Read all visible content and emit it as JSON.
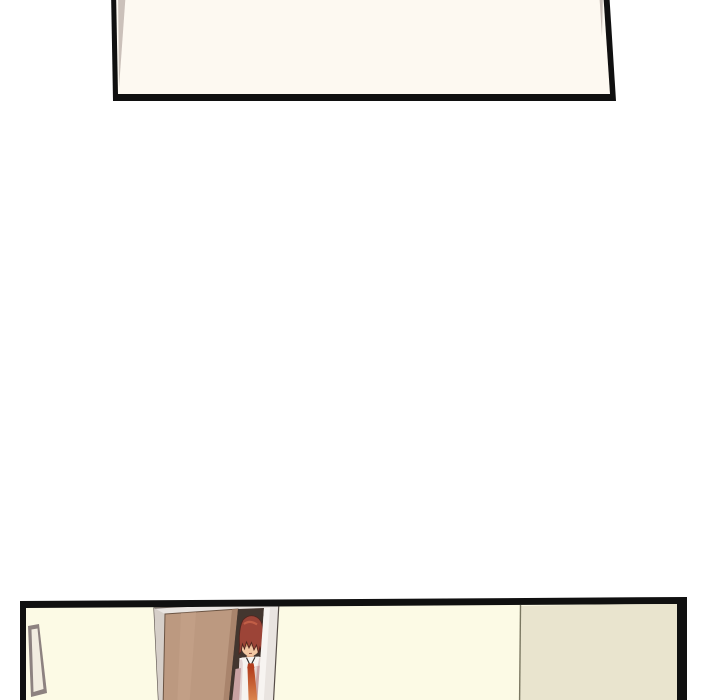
{
  "page": {
    "background_color": "#ffffff"
  },
  "panel_border_color": "#101010",
  "top_panel": {
    "wall_color": "#fdf9f1",
    "corner_shade_color": "#cbc1ba"
  },
  "bottom_panel": {
    "wall_color": "#fcfae5",
    "side_wall_color": "#e9e4ce",
    "wall_seam_color": "#6e6a55",
    "doorway_shadow_color": "#43362f",
    "door": {
      "fill": "#bc9980",
      "edge_shade": "#a9846c",
      "highlight": "#c9a78f",
      "outline": "#6b5443"
    },
    "door_frame": {
      "fill": "#e9e4e0",
      "outline": "#564d48",
      "jamb_shade": "#d6cfc9",
      "highlight": "#f7f4f1"
    },
    "picture_frame": {
      "border_color": "#8d8280",
      "fill": "#f2ede0"
    },
    "character": {
      "hair_color": "#9c4437",
      "hair_highlight": "#c56248",
      "hair_outline": "#50261f",
      "skin_color": "#f2c8a3",
      "neck_shade": "#dfab88",
      "eye_shadow_color": "#a26b52",
      "eye_color": "#e09a3f",
      "mouth_color": "#8a4a3a",
      "shirt_color": "#f6f3ef",
      "shirt_shade": "#d9bfbf",
      "collar_line_color": "#2e2a28",
      "jacket_color": "#c9a2a3",
      "tie_color_top": "#b33e1d",
      "tie_color_bottom": "#e99e60"
    }
  }
}
